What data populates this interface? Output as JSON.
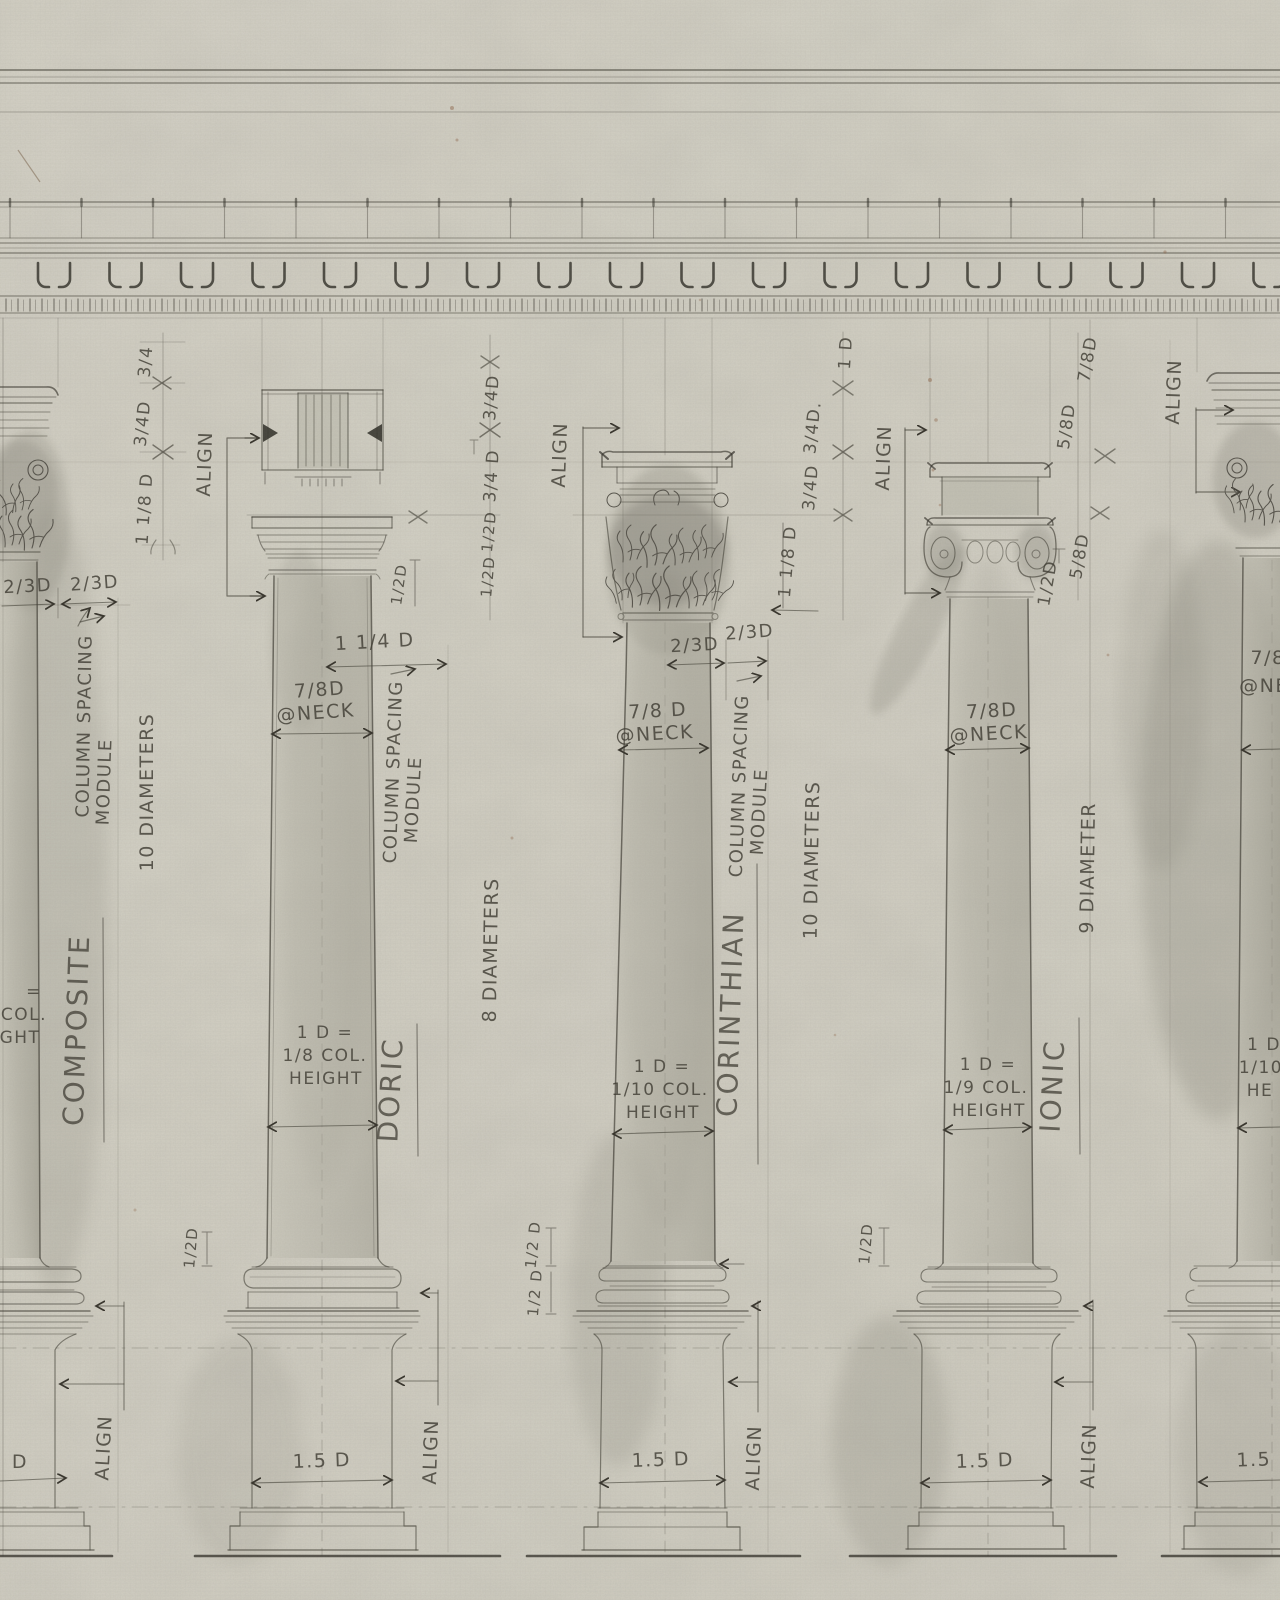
{
  "drawing": {
    "align_label": "ALIGN",
    "composite": {
      "name": "COMPOSITE",
      "diameters": "10 DIAMETERS",
      "module_line1": "COLUMN SPACING",
      "module_line2": "MODULE",
      "abacus_left": "2/3D",
      "abacus_right": "2/3D",
      "chain_top": "3/4",
      "chain_mid": "3/4D",
      "chain_bottom": "1 1/8 D",
      "height_frag1": "=",
      "height_frag2": "COL.",
      "height_frag3": "GHT",
      "plinth_frag": "D"
    },
    "doric": {
      "name": "DORIC",
      "diameters": "8 DIAMETERS",
      "module_line1": "COLUMN SPACING",
      "module_line2": "MODULE",
      "spacing": "1 1/4 D",
      "neck_line1": "7/8D",
      "neck_line2": "@NECK",
      "cap_half": "1/2D",
      "chain1": "3/4D",
      "chain2": "3/4 D",
      "chain3": "1/2D",
      "chain4": "1/2D",
      "height1": "1 D =",
      "height2": "1/8 COL.",
      "height3": "HEIGHT",
      "base_half": "1/2D",
      "plinth": "1.5 D"
    },
    "corinthian": {
      "name": "CORINTHIAN",
      "diameters": "10 DIAMETERS",
      "module_line1": "COLUMN SPACING",
      "module_line2": "MODULE",
      "abacus_left": "2/3D",
      "abacus_right": "2/3D",
      "cap_height": "1 1/8 D",
      "gap_label": "1 D",
      "chain1": "3/4D.",
      "chain2": "3/4D",
      "neck_line1": "7/8 D",
      "neck_line2": "@NECK",
      "height1": "1 D =",
      "height2": "1/10 COL.",
      "height3": "HEIGHT",
      "base_half1": "1/2 D",
      "base_half2": "1/2 D",
      "plinth": "1.5 D"
    },
    "ionic": {
      "name": "IONIC",
      "diameters": "9 DIAMETER",
      "neck_line1": "7/8D",
      "neck_line2": "@NECK",
      "height1": "1 D =",
      "height2": "1/9 COL.",
      "height3": "HEIGHT",
      "base_half": "1/2D",
      "plinth": "1.5 D"
    },
    "right_column": {
      "chain1": "7/8D",
      "chain2": "5/8D",
      "chain3": "5/8D",
      "chain4": "1/2D",
      "neck_frag1": "7/8",
      "neck_frag2": "@NE",
      "height_frag1": "1 D",
      "height_frag2": "1/10",
      "height_frag3": "HE",
      "plinth_frag": "1.5"
    }
  }
}
